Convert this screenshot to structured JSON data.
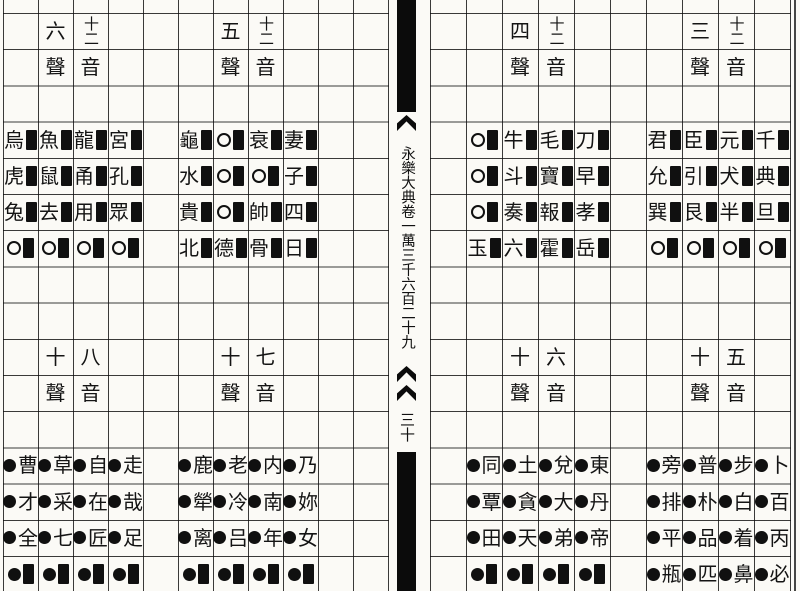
{
  "page": {
    "paper_color": "#fbfaf6",
    "ink_color": "#141414",
    "grid_line_color": "#0f0f0f"
  },
  "spine": {
    "volume_title": "永樂大典卷一萬三千六百二十九",
    "page_number": "三十"
  },
  "tables": [
    {
      "name": "top-far-left",
      "title": "十二音六聲",
      "section": "top",
      "half": "left",
      "col_start": 0,
      "header": {
        "sheng_num": "六",
        "sheng_label": "聲",
        "yin_num": "十二",
        "yin_label": "音"
      },
      "rows": [
        [
          "烏",
          "魚",
          "龍",
          "宮"
        ],
        [
          "虎",
          "鼠",
          "甬",
          "孔"
        ],
        [
          "兔",
          "去",
          "用",
          "眾"
        ],
        [
          "○",
          "○",
          "○",
          "○"
        ]
      ]
    },
    {
      "name": "top-mid-left",
      "title": "十二音五聲",
      "section": "top",
      "half": "left",
      "col_start": 5,
      "header": {
        "sheng_num": "五",
        "sheng_label": "聲",
        "yin_num": "十二",
        "yin_label": "音"
      },
      "rows": [
        [
          "龜",
          "○",
          "衰",
          "妻"
        ],
        [
          "水",
          "○",
          "○",
          "子"
        ],
        [
          "貴",
          "○",
          "帥",
          "四"
        ],
        [
          "北",
          "德",
          "骨",
          "日"
        ]
      ]
    },
    {
      "name": "top-mid-right",
      "title": "十二音四聲",
      "section": "top",
      "half": "right",
      "col_start": 1,
      "header": {
        "sheng_num": "四",
        "sheng_label": "聲",
        "yin_num": "十二",
        "yin_label": "音"
      },
      "rows": [
        [
          "○",
          "牛",
          "毛",
          "刀"
        ],
        [
          "○",
          "斗",
          "寶",
          "早"
        ],
        [
          "○",
          "奏",
          "報",
          "孝"
        ],
        [
          "玉",
          "六",
          "霍",
          "岳"
        ]
      ]
    },
    {
      "name": "top-far-right",
      "title": "十二音三聲",
      "section": "top",
      "half": "right",
      "col_start": 6,
      "header": {
        "sheng_num": "三",
        "sheng_label": "聲",
        "yin_num": "十二",
        "yin_label": "音"
      },
      "rows": [
        [
          "君",
          "臣",
          "元",
          "千"
        ],
        [
          "允",
          "引",
          "犬",
          "典"
        ],
        [
          "巽",
          "艮",
          "半",
          "旦"
        ],
        [
          "○",
          "○",
          "○",
          "○"
        ]
      ]
    },
    {
      "name": "bottom-far-left",
      "title": "八音十聲",
      "section": "bottom",
      "half": "left",
      "col_start": 0,
      "header": {
        "sheng_num": "十",
        "sheng_label": "聲",
        "yin_num": "八",
        "yin_label": "音"
      },
      "rows": [
        [
          "曹",
          "草",
          "自",
          "走"
        ],
        [
          "才",
          "采",
          "在",
          "哉"
        ],
        [
          "全",
          "七",
          "匠",
          "足"
        ],
        [
          "■",
          "■",
          "■",
          "■"
        ]
      ]
    },
    {
      "name": "bottom-mid-left",
      "title": "七音十聲",
      "section": "bottom",
      "half": "left",
      "col_start": 5,
      "header": {
        "sheng_num": "十",
        "sheng_label": "聲",
        "yin_num": "七",
        "yin_label": "音"
      },
      "rows": [
        [
          "鹿",
          "老",
          "内",
          "乃"
        ],
        [
          "犖",
          "冷",
          "南",
          "妳"
        ],
        [
          "离",
          "吕",
          "年",
          "女"
        ],
        [
          "■",
          "■",
          "■",
          "■"
        ]
      ]
    },
    {
      "name": "bottom-mid-right",
      "title": "六音十聲",
      "section": "bottom",
      "half": "right",
      "col_start": 1,
      "header": {
        "sheng_num": "十",
        "sheng_label": "聲",
        "yin_num": "六",
        "yin_label": "音"
      },
      "rows": [
        [
          "同",
          "土",
          "兌",
          "東"
        ],
        [
          "覃",
          "貪",
          "大",
          "丹"
        ],
        [
          "田",
          "天",
          "弟",
          "帝"
        ],
        [
          "■",
          "■",
          "■",
          "■"
        ]
      ]
    },
    {
      "name": "bottom-far-right",
      "title": "五音十聲",
      "section": "bottom",
      "half": "right",
      "col_start": 6,
      "header": {
        "sheng_num": "十",
        "sheng_label": "聲",
        "yin_num": "五",
        "yin_label": "音"
      },
      "rows": [
        [
          "旁",
          "普",
          "步",
          "卜"
        ],
        [
          "排",
          "朴",
          "白",
          "百"
        ],
        [
          "平",
          "品",
          "着",
          "丙"
        ],
        [
          "瓶",
          "匹",
          "鼻",
          "必"
        ]
      ]
    }
  ]
}
